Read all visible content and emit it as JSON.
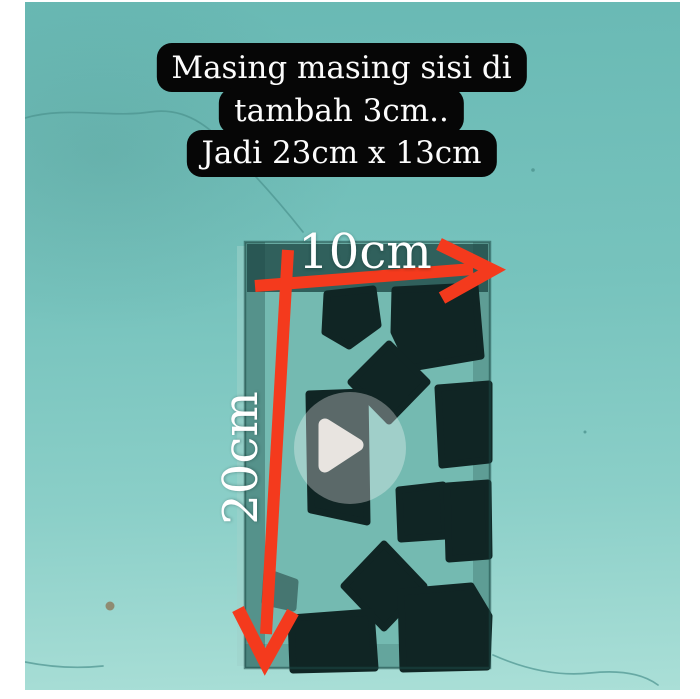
{
  "colors": {
    "page-bg": "#ffffff",
    "wall-top": "#69b9b4",
    "wall-mid": "#77c3bd",
    "wall-light": "#8bcfc8",
    "wall-bottom": "#aadfd7",
    "wall-crack": "#4c938e",
    "block-face": "#74bab1",
    "block-top-shade": "#24504d",
    "block-edge": "#1c4845",
    "plaster": "#9ed2cb",
    "hole": "#102524",
    "arrow-red": "#f43a1d",
    "caption-bg": "#060606",
    "caption-fg": "#fcfcfc",
    "label-fg": "#ffffff",
    "play-fill": "#f3eeea",
    "play-circle": "rgba(255,255,255,0.18)",
    "pebble": "#8d7f62"
  },
  "caption": {
    "lines": [
      "Masing masing sisi di",
      "tambah 3cm..",
      "Jadi 23cm x 13cm"
    ]
  },
  "measurements": {
    "width": {
      "label": "10cm"
    },
    "height": {
      "label": "20cm"
    }
  },
  "video": {
    "play_icon_shape": "triangle-right"
  }
}
